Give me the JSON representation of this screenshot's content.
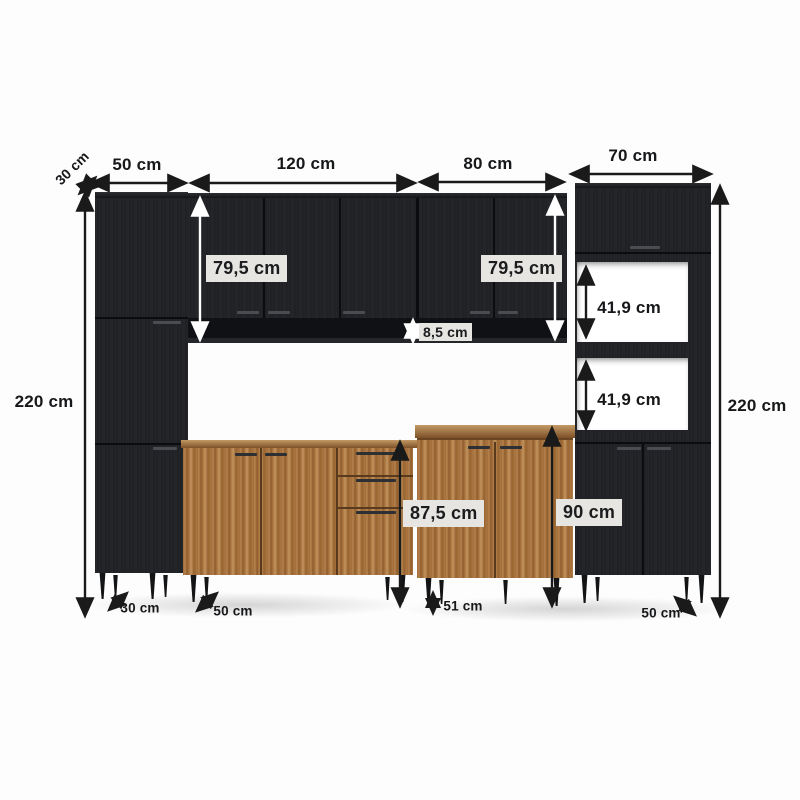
{
  "diagram": {
    "subject": "modular-kitchen-cabinet-dimension-diagram",
    "palette": {
      "background": "#fdfdfd",
      "cabinet_black": "#212226",
      "cabinet_wood": "#a5713d",
      "label_box_bg": "#e7e5e2",
      "arrow_dark": "#1a1a1a",
      "arrow_light": "#ffffff",
      "text": "#17181a"
    },
    "labels": {
      "depth_top_left": "30 cm",
      "top_width_left_cabinet": "50 cm",
      "top_width_wall_center": "120 cm",
      "top_width_wall_right": "80 cm",
      "top_width_tower": "70 cm",
      "total_height_left": "220 cm",
      "total_height_right": "220 cm",
      "upper_cabinet_height_left": "79,5 cm",
      "upper_cabinet_height_right": "79,5 cm",
      "shelf_strip_height": "8,5 cm",
      "tower_niche_top_height": "41,9 cm",
      "tower_niche_bottom_height": "41,9 cm",
      "base_cabinet_height": "87,5 cm",
      "counter_cabinet_height": "90 cm",
      "depth_bottom_left": "30 cm",
      "depth_base_left": "50 cm",
      "base_leg_dim": "51 cm",
      "depth_base_right": "50 cm"
    }
  }
}
